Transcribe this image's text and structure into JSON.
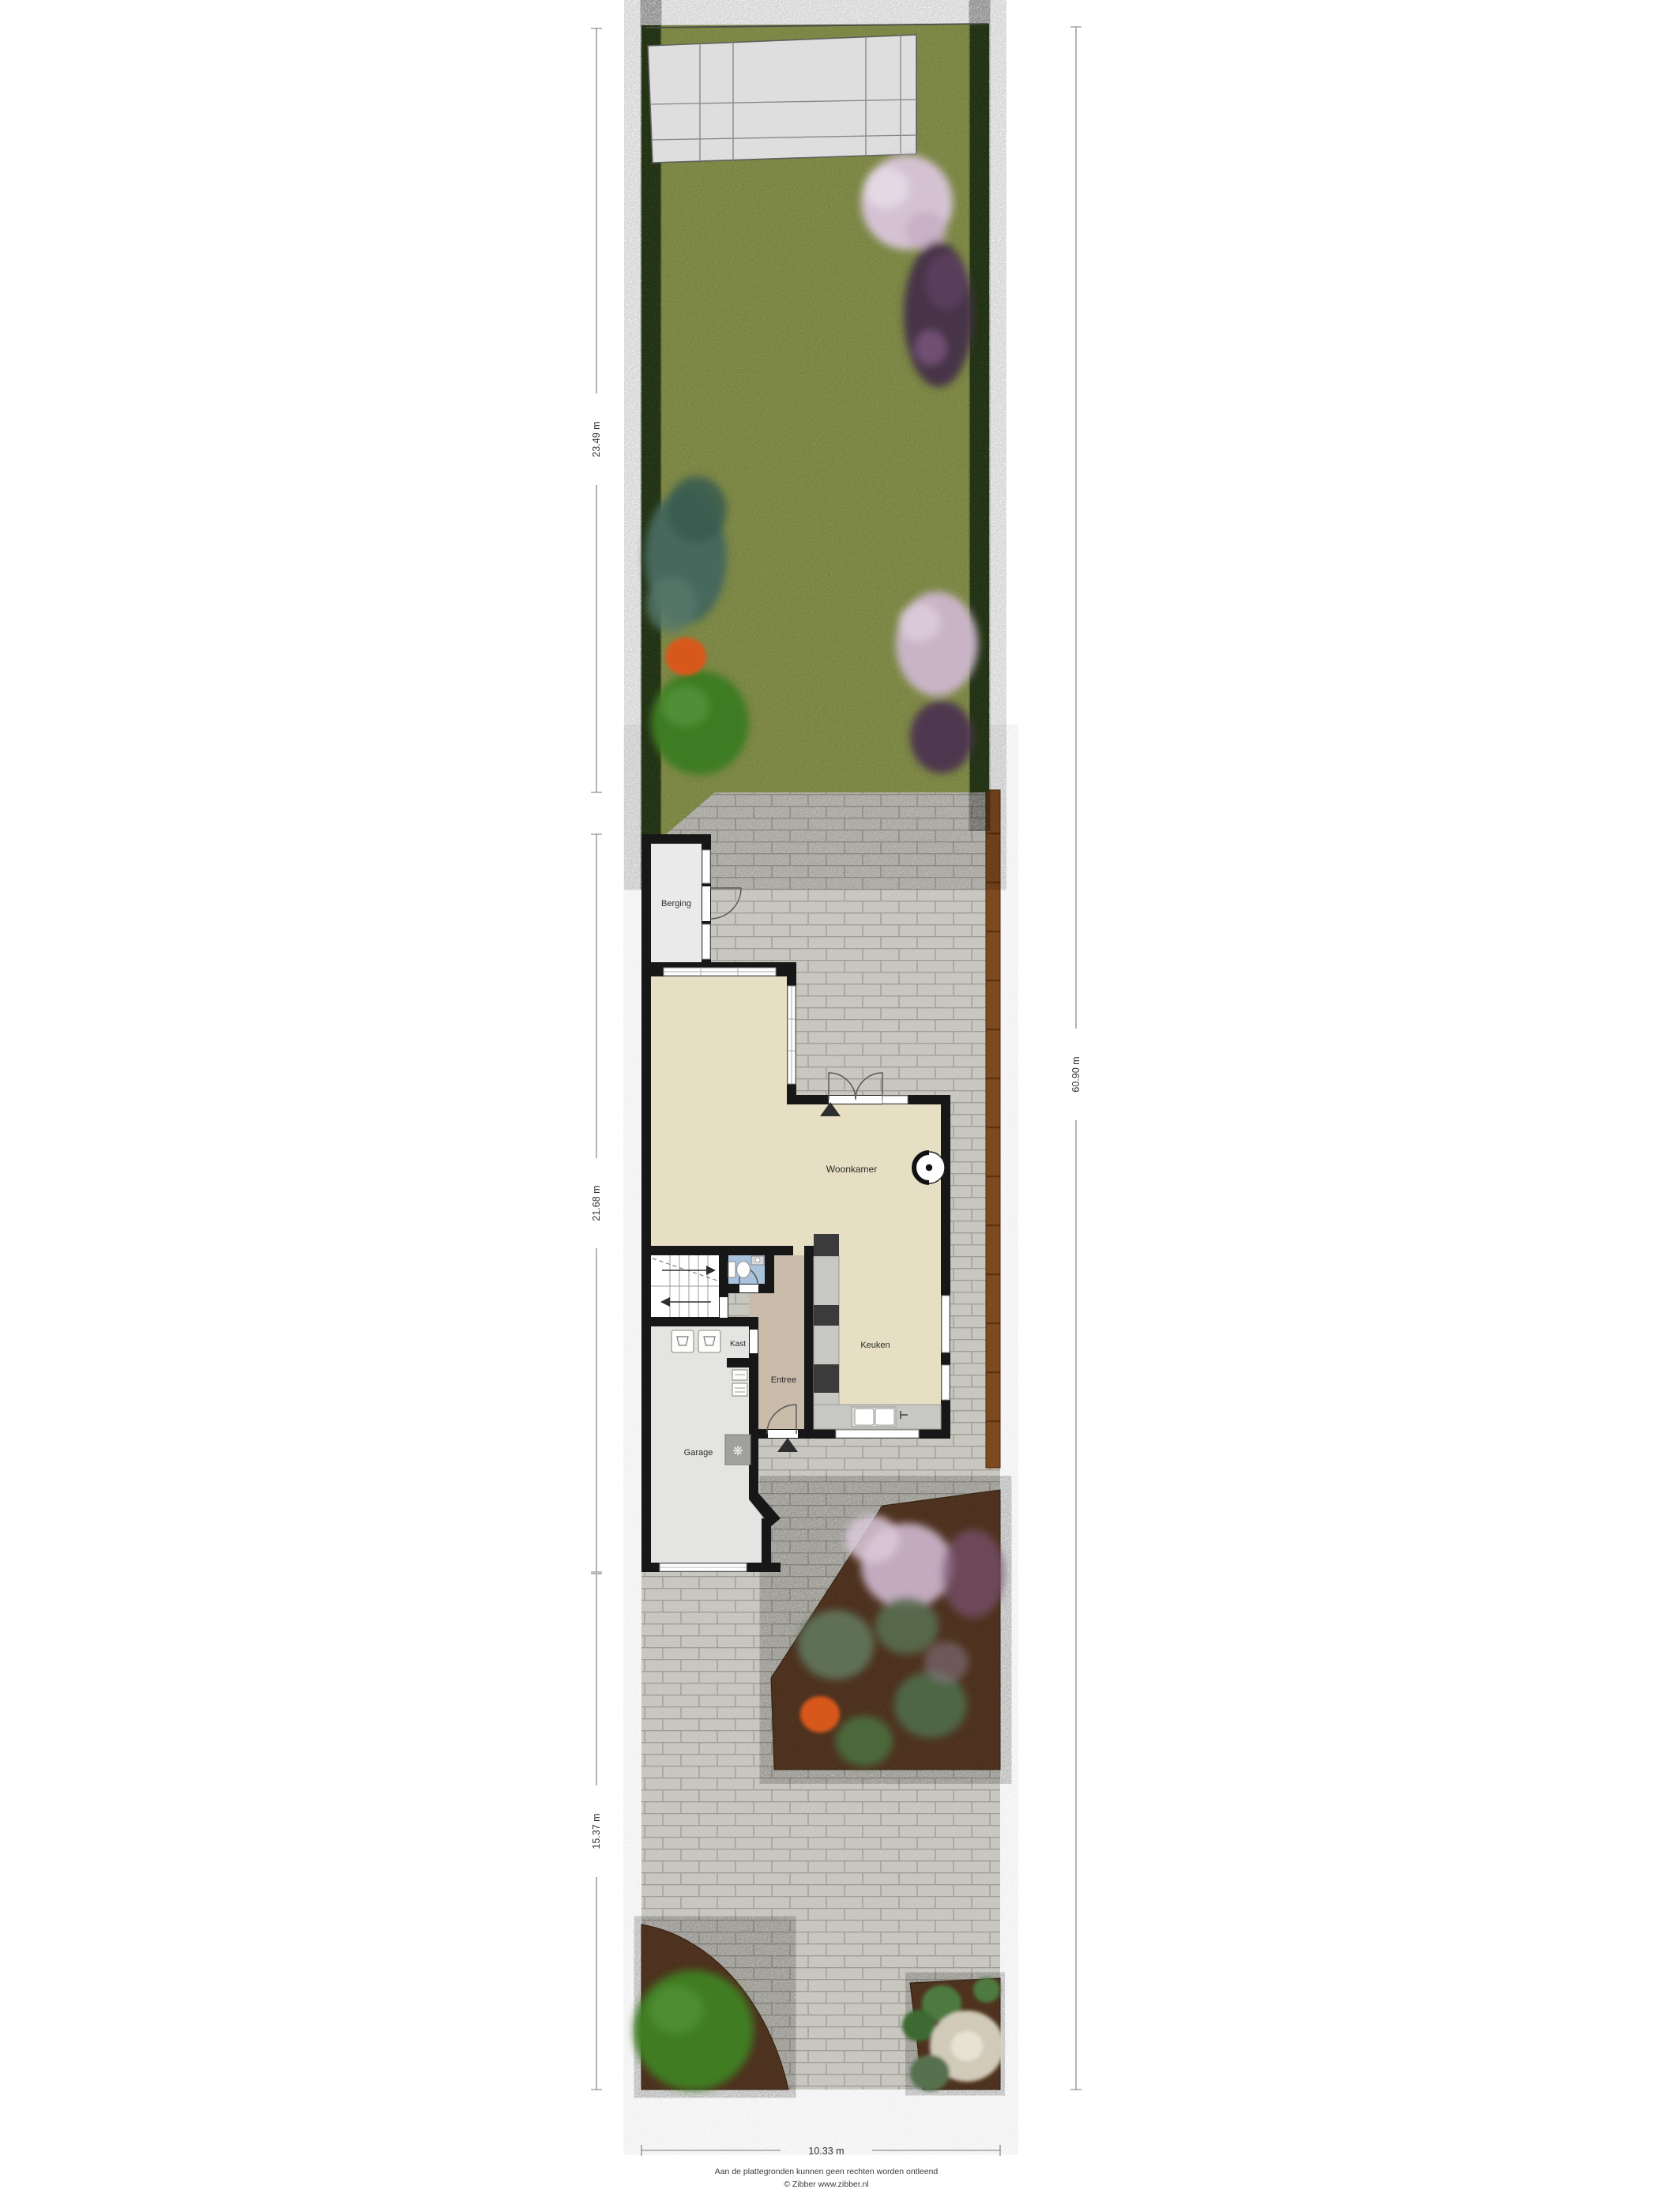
{
  "rooms": {
    "berging": "Berging",
    "woonkamer": "Woonkamer",
    "keuken": "Keuken",
    "entree": "Entree",
    "kast": "Kast",
    "garage": "Garage"
  },
  "dimensions": {
    "garden_depth": "23.49 m",
    "house_depth": "21.68 m",
    "driveway_depth": "15.37 m",
    "total_depth": "60.90 m",
    "plot_width": "10.33 m"
  },
  "footer": {
    "line1": "Aan de plattegronden kunnen geen rechten worden ontleend",
    "line2": "© Zibber www.zibber.nl"
  },
  "glyphs": {
    "doormat": "❋"
  },
  "colors": {
    "grass": "#909c51",
    "hedge": "#33491f",
    "patio_tiles": "#dedede",
    "paving": "#d1d0c8",
    "paving_joint": "#a7a59c",
    "fence": "#7d4a1f",
    "soil": "#5e3d26",
    "wall": "#171717",
    "floor_living": "#e6dfc3",
    "floor_entree": "#c9bcaa",
    "floor_garage": "#e4e4e2",
    "floor_berging": "#eaeaea",
    "floor_toilet": "#a9c3dd",
    "counter": "#c7c7c3"
  }
}
